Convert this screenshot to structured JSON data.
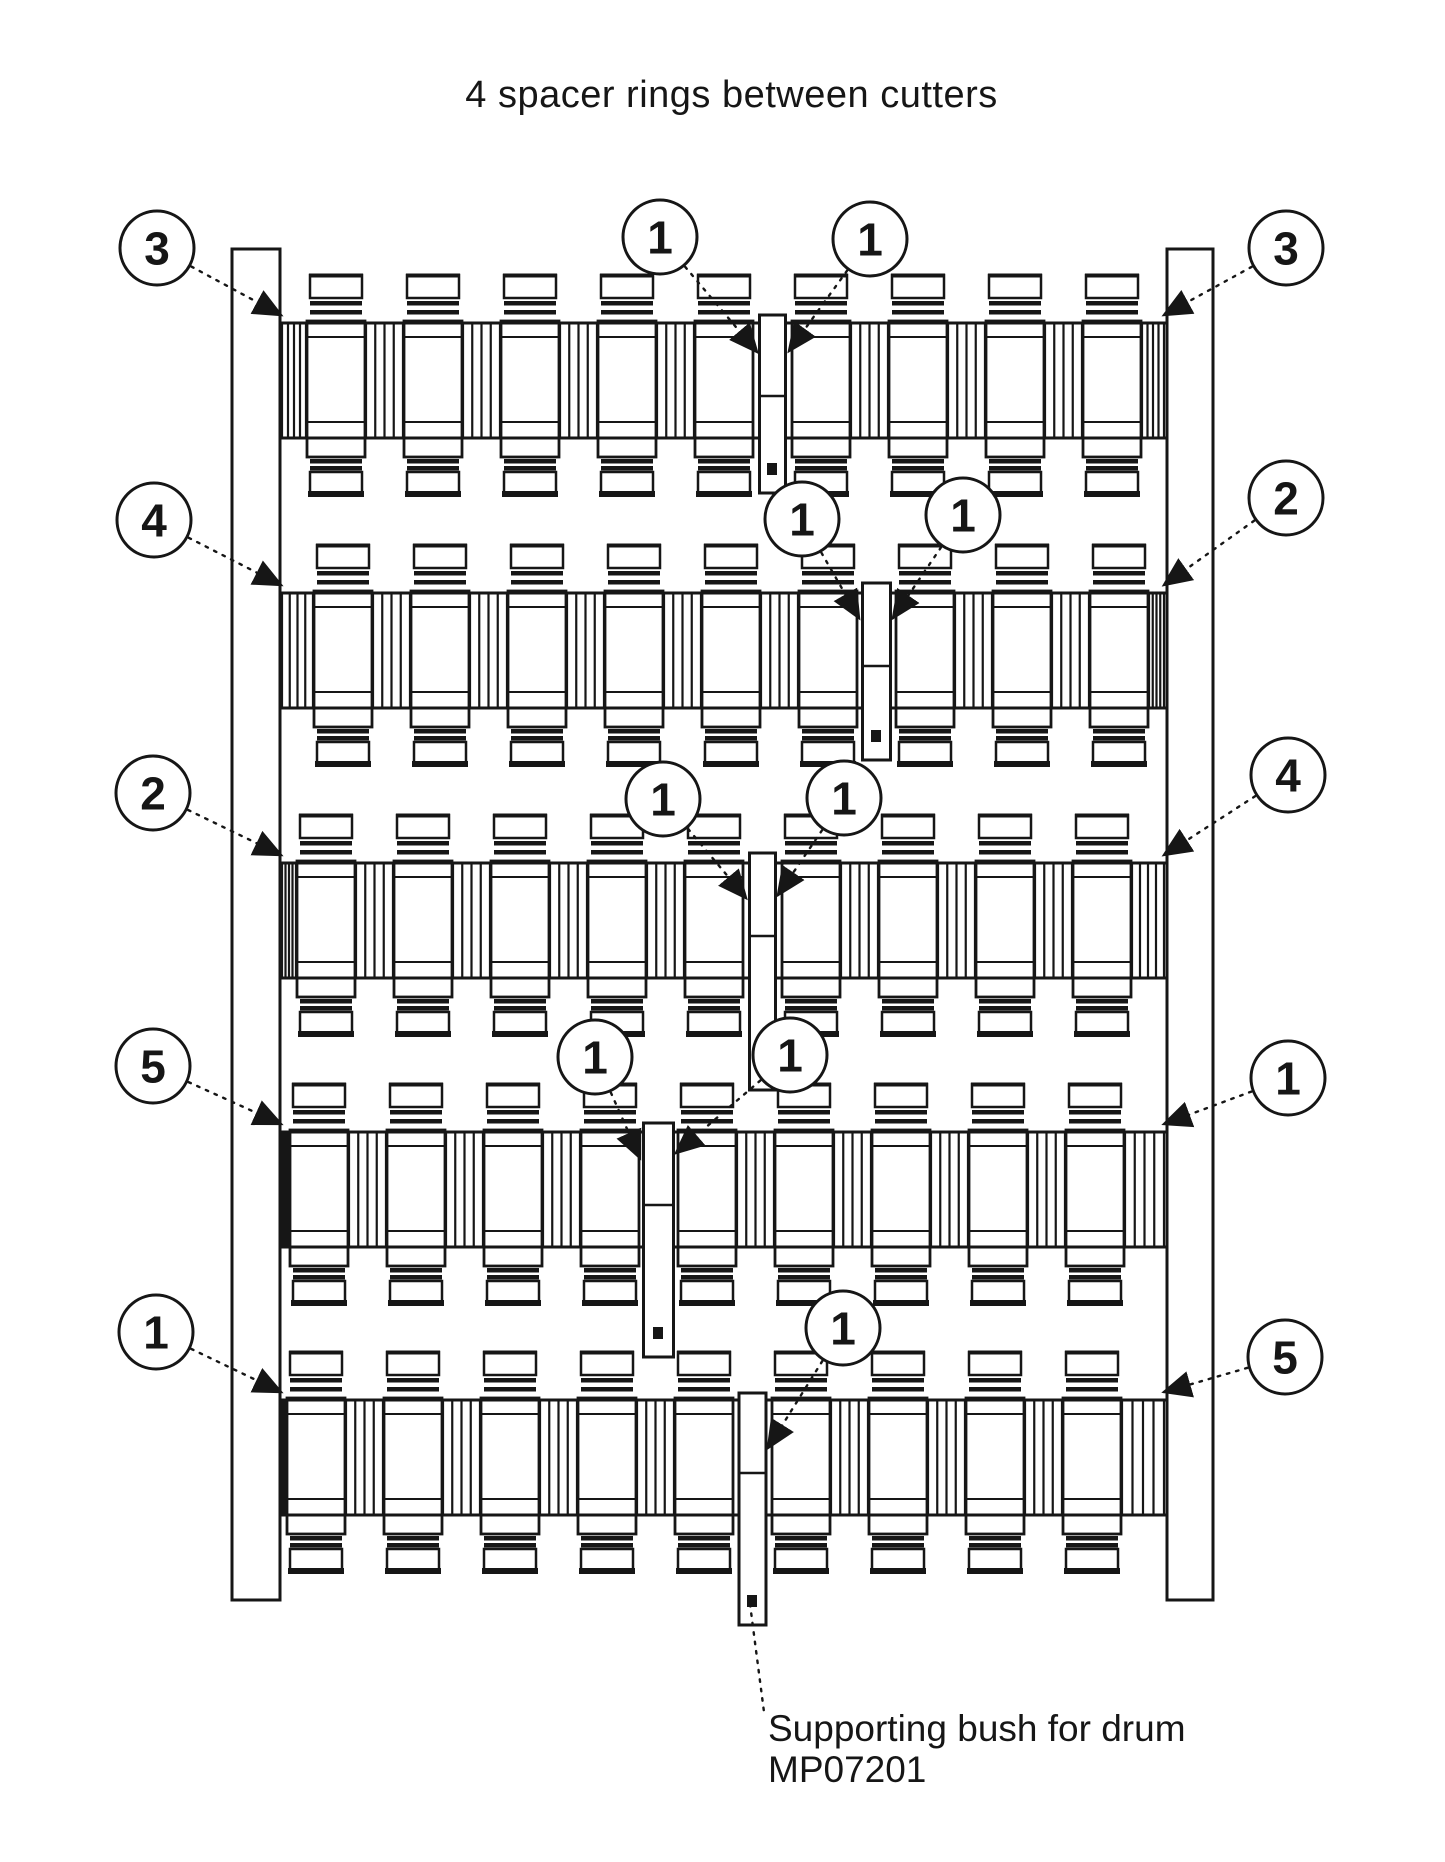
{
  "title": "4 spacer rings between cutters",
  "caption": {
    "line1": "Supporting bush for drum",
    "line2": "MP07201",
    "leader": {
      "x1": 750,
      "y1": 1604,
      "x2": 764,
      "y2": 1712
    }
  },
  "colors": {
    "ink": "#161616",
    "paper": "#ffffff"
  },
  "assembly": {
    "rows_count": 5,
    "cutters_per_row": 9,
    "spacer_rings_between_cutters": 4,
    "plates": {
      "left_x": 232,
      "left_w": 48,
      "right_x": 1167,
      "right_w": 46,
      "top": 249,
      "bottom": 1600
    },
    "band": {
      "x_left": 280,
      "x_right": 1167,
      "height": 115
    },
    "cutter": {
      "pitch": 97,
      "cap_w": 52,
      "body_w": 58
    },
    "rows": [
      {
        "band_top": 323,
        "x0": 310,
        "bush_gap": 4,
        "bush_w": 26,
        "bush_top": 315,
        "bush_bottom": 493
      },
      {
        "band_top": 593,
        "x0": 317,
        "bush_gap": 5,
        "bush_w": 28,
        "bush_top": 583,
        "bush_bottom": 760
      },
      {
        "band_top": 863,
        "x0": 300,
        "bush_gap": 4,
        "bush_w": 26,
        "bush_top": 853,
        "bush_bottom": 1090
      },
      {
        "band_top": 1132,
        "x0": 293,
        "bush_gap": 3,
        "bush_w": 30,
        "bush_top": 1123,
        "bush_bottom": 1357
      },
      {
        "band_top": 1400,
        "x0": 290,
        "bush_gap": 4,
        "bush_w": 27,
        "bush_top": 1393,
        "bush_bottom": 1625
      }
    ]
  },
  "callouts": [
    {
      "label": "3",
      "x": 157,
      "y": 248,
      "tip_x": 281,
      "tip_y": 315
    },
    {
      "label": "4",
      "x": 154,
      "y": 520,
      "tip_x": 281,
      "tip_y": 585
    },
    {
      "label": "2",
      "x": 153,
      "y": 793,
      "tip_x": 281,
      "tip_y": 855
    },
    {
      "label": "5",
      "x": 153,
      "y": 1066,
      "tip_x": 281,
      "tip_y": 1124
    },
    {
      "label": "1",
      "x": 156,
      "y": 1332,
      "tip_x": 281,
      "tip_y": 1392
    },
    {
      "label": "3",
      "x": 1286,
      "y": 248,
      "tip_x": 1164,
      "tip_y": 315
    },
    {
      "label": "2",
      "x": 1286,
      "y": 498,
      "tip_x": 1164,
      "tip_y": 585
    },
    {
      "label": "4",
      "x": 1288,
      "y": 775,
      "tip_x": 1164,
      "tip_y": 855
    },
    {
      "label": "1",
      "x": 1288,
      "y": 1078,
      "tip_x": 1164,
      "tip_y": 1124
    },
    {
      "label": "5",
      "x": 1285,
      "y": 1357,
      "tip_x": 1164,
      "tip_y": 1392
    },
    {
      "label": "1",
      "x": 660,
      "y": 237,
      "tip_x": 757,
      "tip_y": 352
    },
    {
      "label": "1",
      "x": 870,
      "y": 239,
      "tip_x": 789,
      "tip_y": 351
    },
    {
      "label": "1",
      "x": 802,
      "y": 519,
      "tip_x": 859,
      "tip_y": 618
    },
    {
      "label": "1",
      "x": 963,
      "y": 515,
      "tip_x": 893,
      "tip_y": 618
    },
    {
      "label": "1",
      "x": 663,
      "y": 799,
      "tip_x": 746,
      "tip_y": 898
    },
    {
      "label": "1",
      "x": 844,
      "y": 798,
      "tip_x": 778,
      "tip_y": 895
    },
    {
      "label": "1",
      "x": 595,
      "y": 1057,
      "tip_x": 640,
      "tip_y": 1158
    },
    {
      "label": "1",
      "x": 790,
      "y": 1055,
      "tip_x": 676,
      "tip_y": 1153
    },
    {
      "label": "1",
      "x": 843,
      "y": 1328,
      "tip_x": 768,
      "tip_y": 1448
    }
  ]
}
